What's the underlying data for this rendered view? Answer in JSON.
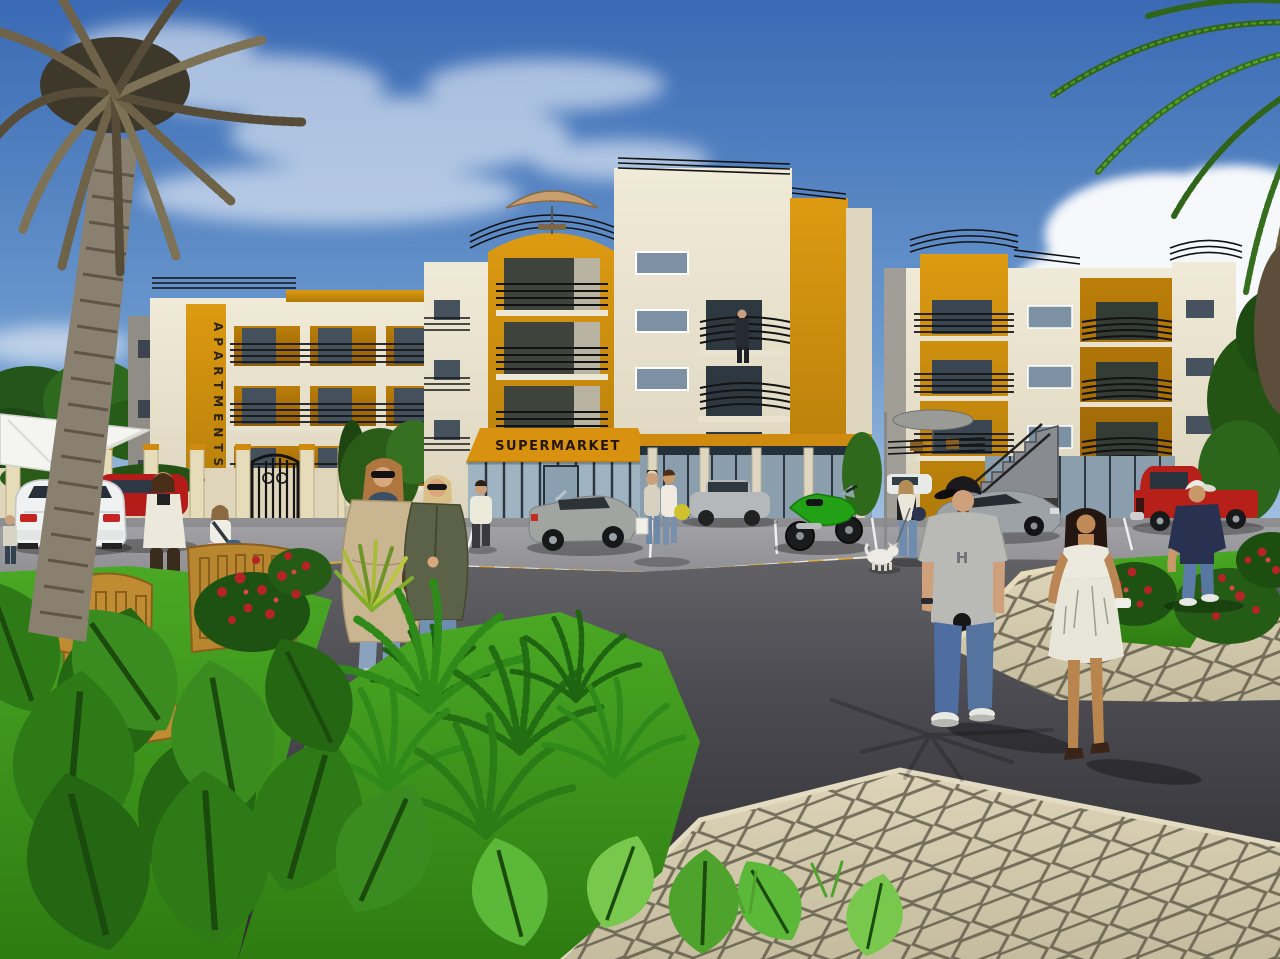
{
  "scene": {
    "type": "3d-architectural-rendering",
    "description": "Exterior visualization of a residential apartment complex with a ground-floor supermarket, parking apron, asphalt road, hexagonal paver walkways, landscaped gardens, palm trees and pedestrians under a blue sky",
    "signs": {
      "apartments_vertical": "APARTMENTS",
      "supermarket": "SUPERMARKET",
      "tshirt_graphic": "H"
    },
    "palette": {
      "sky_top": "#3a6ab4",
      "sky_horizon": "#cfdcec",
      "building_cream": "#ece5d1",
      "building_grey": "#8f8d85",
      "accent_orange": "#d08c0e",
      "awning_orange": "#d8920f",
      "railing_black": "#141414",
      "window_glass": "#7c92a4",
      "asphalt_road": "#3a3a3e",
      "parking_apron": "#9a9a9e",
      "kerb_yellow": "#d8a83a",
      "kerb_white": "#f0ead6",
      "paver_beige": "#d7cdb2",
      "grass_green": "#3f9e20",
      "rose_red": "#b42426"
    },
    "buildings": [
      {
        "name": "left-apartment-block",
        "floors": 3,
        "features": [
          "vertical APARTMENTS sign on orange pier",
          "balconies with black railings",
          "grey side elevation",
          "orange roof box",
          "boundary wall with ornamental iron gate"
        ]
      },
      {
        "name": "center-apartment-block",
        "floors": 4,
        "features": [
          "curved orange balcony tower",
          "roof terrace with tan umbrella",
          "SUPERMARKET awning over glass storefront",
          "ground floor shop colonnade",
          "resident standing on balcony"
        ]
      },
      {
        "name": "right-apartment-block",
        "floors": 3,
        "features": [
          "curved corner roof railings",
          "external access staircase",
          "terrace with grey umbrella",
          "glass storefronts",
          "curved orange balconies"
        ]
      }
    ],
    "vehicles": [
      {
        "name": "white-roadster",
        "color": "white",
        "position": "left parking, rear view"
      },
      {
        "name": "red-hatchback",
        "color": "red",
        "position": "left, beside white roadster"
      },
      {
        "name": "grey-compact",
        "color": "grey",
        "position": "behind boundary wall"
      },
      {
        "name": "silver-convertible",
        "color": "silver",
        "position": "parked in front of supermarket"
      },
      {
        "name": "silver-sedan",
        "color": "silver",
        "position": "center-right parking"
      },
      {
        "name": "white-compact",
        "color": "white",
        "position": "distant right parking"
      },
      {
        "name": "green-sport-motorcycle",
        "color": "green",
        "position": "right of supermarket"
      },
      {
        "name": "silver-sports-car",
        "color": "silver",
        "position": "behind man in grey t-shirt"
      },
      {
        "name": "red-pickup-truck",
        "color": "red",
        "position": "far right parking"
      }
    ],
    "people": [
      {
        "name": "woman-white-cardigan",
        "description": "brown-haired woman in white cardigan and dark brown trousers"
      },
      {
        "name": "girl-with-shoulder-bag",
        "description": "girl in white top, pink skirt, blue shoulder bag"
      },
      {
        "name": "woman-beige-coat",
        "description": "woman with sunglasses, dark patterned scarf, long beige coat, ripped jeans, brown bag"
      },
      {
        "name": "woman-olive-jacket",
        "description": "blonde woman with sunglasses in olive green jacket and flared jeans"
      },
      {
        "name": "man-white-shirt",
        "description": "man in white shirt and dark trousers walking toward the gate"
      },
      {
        "name": "shoppers-with-bags",
        "description": "two shoppers with white and yellow carrier bags outside the supermarket"
      },
      {
        "name": "woman-walking-dog",
        "description": "woman in white top and jeans walking a small white dog on a leash"
      },
      {
        "name": "man-grey-tshirt",
        "description": "heavy-set man in black cap, grey H graphic t-shirt, blue jeans, white sneakers"
      },
      {
        "name": "woman-white-dress",
        "description": "dark-haired tanned woman in white strapless mini dress and heels"
      },
      {
        "name": "man-navy-tshirt",
        "description": "man in white cap, navy t-shirt and jeans on the paver path"
      },
      {
        "name": "balcony-resident",
        "description": "figure in dark suit standing on an upper balcony"
      },
      {
        "name": "pedestrian-left-edge",
        "description": "partially visible pedestrian at far left edge"
      }
    ],
    "vegetation": [
      "dry date palm with hanging fronds, left foreground",
      "green palm fronds, top right corner",
      "tropical broad-leaf bed, bottom left",
      "fern bed on lawn, bottom center",
      "red rose bushes left and right",
      "spiky yucca plant",
      "background trees and hedges"
    ],
    "ground": [
      "dark asphalt road",
      "light parking apron with white bay lines",
      "yellow and white striped kerbs",
      "hexagonal paver pedestrian walkways",
      "green lawn strips"
    ],
    "furniture": [
      "two wooden garden chairs",
      "white shade canopy",
      "roof terrace umbrellas"
    ],
    "sky": {
      "description": "clear blue sky, wispy clouds upper left, bright cumulus behind right palm"
    }
  }
}
